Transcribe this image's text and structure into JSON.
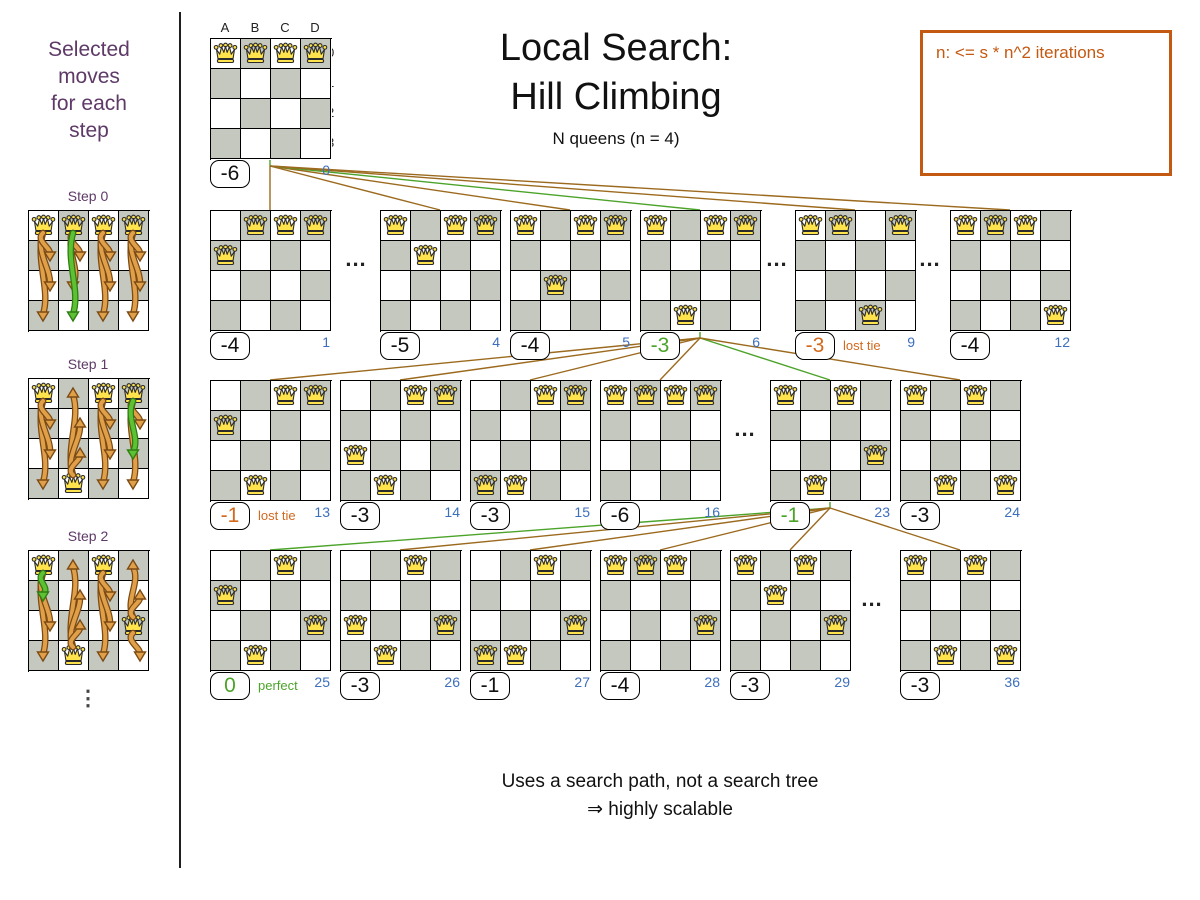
{
  "colors": {
    "purple": "#5e3a67",
    "blue": "#3d6fbe",
    "green": "#4ca32a",
    "orange": "#d2691e",
    "note_orange": "#c45911",
    "line_brown": "#9c6a1e",
    "dark_cell": "#c4c8bf",
    "queen_fill": "#ffe34d"
  },
  "sidebar": {
    "caption_lines": [
      "Selected",
      "moves",
      "for each",
      "step"
    ],
    "steps": [
      {
        "label": "Step 0",
        "queens": [
          "A0",
          "B0",
          "C0",
          "D0"
        ],
        "arrows": [
          {
            "col": "A",
            "from": 0,
            "heads": [
              1,
              2,
              3
            ],
            "color": "orange"
          },
          {
            "col": "B",
            "from": 0,
            "heads": [
              1,
              2
            ],
            "color": "orange"
          },
          {
            "col": "B",
            "from": 0,
            "heads": [
              3
            ],
            "color": "green"
          },
          {
            "col": "C",
            "from": 0,
            "heads": [
              1,
              2,
              3
            ],
            "color": "orange"
          },
          {
            "col": "D",
            "from": 0,
            "heads": [
              1,
              2,
              3
            ],
            "color": "orange"
          }
        ]
      },
      {
        "label": "Step 1",
        "queens": [
          "A0",
          "C0",
          "D0",
          "B3"
        ],
        "arrows": [
          {
            "col": "A",
            "from": 0,
            "heads": [
              1,
              2,
              3
            ],
            "color": "orange"
          },
          {
            "col": "B",
            "from": 3,
            "heads": [
              2,
              1,
              0
            ],
            "color": "orange"
          },
          {
            "col": "C",
            "from": 0,
            "heads": [
              1,
              2,
              3
            ],
            "color": "orange"
          },
          {
            "col": "D",
            "from": 0,
            "heads": [
              1,
              3
            ],
            "color": "orange"
          },
          {
            "col": "D",
            "from": 0,
            "heads": [
              2
            ],
            "color": "green"
          }
        ]
      },
      {
        "label": "Step 2",
        "queens": [
          "A0",
          "C0",
          "D2",
          "B3"
        ],
        "arrows": [
          {
            "col": "A",
            "from": 0,
            "heads": [
              2,
              3
            ],
            "color": "orange"
          },
          {
            "col": "A",
            "from": 0,
            "heads": [
              1
            ],
            "color": "green"
          },
          {
            "col": "B",
            "from": 3,
            "heads": [
              2,
              1,
              0
            ],
            "color": "orange"
          },
          {
            "col": "C",
            "from": 0,
            "heads": [
              1,
              2,
              3
            ],
            "color": "orange"
          },
          {
            "col": "D",
            "from": 2,
            "heads": [
              0,
              1,
              3
            ],
            "color": "orange"
          }
        ]
      }
    ],
    "more_indicator": "⋮"
  },
  "header": {
    "title_line1": "Local Search:",
    "title_line2": "Hill Climbing",
    "subtitle": "N queens (n = 4)"
  },
  "note_box": {
    "text": "n: <= s * n^2 iterations"
  },
  "root": {
    "col_labels": [
      "A",
      "B",
      "C",
      "D"
    ],
    "row_labels": [
      "0",
      "1",
      "2",
      "3"
    ],
    "board": {
      "x": 210,
      "queens": [
        "A0",
        "B0",
        "C0",
        "D0"
      ],
      "score": "-6",
      "score_color": "black",
      "index": "0",
      "selected": true
    }
  },
  "levels": [
    {
      "y": 210,
      "boards": [
        {
          "x": 210,
          "queens": [
            "B0",
            "C0",
            "D0",
            "A1"
          ],
          "score": "-4",
          "score_color": "black",
          "index": "1"
        },
        {
          "x": 380,
          "queens": [
            "A0",
            "C0",
            "D0",
            "B1"
          ],
          "score": "-5",
          "score_color": "black",
          "index": "4"
        },
        {
          "x": 510,
          "queens": [
            "A0",
            "C0",
            "D0",
            "B2"
          ],
          "score": "-4",
          "score_color": "black",
          "index": "5"
        },
        {
          "x": 640,
          "queens": [
            "A0",
            "C0",
            "D0",
            "B3"
          ],
          "score": "-3",
          "score_color": "green",
          "index": "6",
          "selected": true
        },
        {
          "x": 795,
          "queens": [
            "A0",
            "B0",
            "D0",
            "C3"
          ],
          "score": "-3",
          "score_color": "orange",
          "tag": "lost tie",
          "tag_color": "orange",
          "index": "9"
        },
        {
          "x": 950,
          "queens": [
            "A0",
            "B0",
            "C0",
            "D3"
          ],
          "score": "-4",
          "score_color": "black",
          "index": "12"
        }
      ],
      "gaps": [
        356,
        777,
        930
      ]
    },
    {
      "y": 380,
      "boards": [
        {
          "x": 210,
          "queens": [
            "C0",
            "D0",
            "A1",
            "B3"
          ],
          "score": "-1",
          "score_color": "orange",
          "tag": "lost tie",
          "tag_color": "orange",
          "index": "13"
        },
        {
          "x": 340,
          "queens": [
            "C0",
            "D0",
            "A2",
            "B3"
          ],
          "score": "-3",
          "score_color": "black",
          "index": "14"
        },
        {
          "x": 470,
          "queens": [
            "C0",
            "D0",
            "A3",
            "B3"
          ],
          "score": "-3",
          "score_color": "black",
          "index": "15"
        },
        {
          "x": 600,
          "queens": [
            "A0",
            "B0",
            "C0",
            "D0"
          ],
          "score": "-6",
          "score_color": "black",
          "index": "16"
        },
        {
          "x": 770,
          "queens": [
            "A0",
            "C0",
            "D2",
            "B3"
          ],
          "score": "-1",
          "score_color": "green",
          "index": "23",
          "selected": true
        },
        {
          "x": 900,
          "queens": [
            "A0",
            "C0",
            "B3",
            "D3"
          ],
          "score": "-3",
          "score_color": "black",
          "index": "24"
        }
      ],
      "gaps": [
        745
      ]
    },
    {
      "y": 550,
      "boards": [
        {
          "x": 210,
          "queens": [
            "C0",
            "A1",
            "D2",
            "B3"
          ],
          "score": "0",
          "score_color": "green",
          "tag": "perfect",
          "tag_color": "green",
          "index": "25",
          "selected": true
        },
        {
          "x": 340,
          "queens": [
            "C0",
            "A2",
            "D2",
            "B3"
          ],
          "score": "-3",
          "score_color": "black",
          "index": "26"
        },
        {
          "x": 470,
          "queens": [
            "C0",
            "D2",
            "A3",
            "B3"
          ],
          "score": "-1",
          "score_color": "black",
          "index": "27"
        },
        {
          "x": 600,
          "queens": [
            "A0",
            "B0",
            "C0",
            "D2"
          ],
          "score": "-4",
          "score_color": "black",
          "index": "28"
        },
        {
          "x": 730,
          "queens": [
            "A0",
            "C0",
            "B1",
            "D2"
          ],
          "score": "-3",
          "score_color": "black",
          "index": "29"
        },
        {
          "x": 900,
          "queens": [
            "A0",
            "C0",
            "B3",
            "D3"
          ],
          "score": "-3",
          "score_color": "black",
          "index": "36"
        }
      ],
      "gaps": [
        872
      ]
    }
  ],
  "misc": {
    "ellipsis": "..."
  },
  "footer": {
    "line1": "Uses a search path, not a search tree",
    "line2": "⇒ highly scalable"
  }
}
